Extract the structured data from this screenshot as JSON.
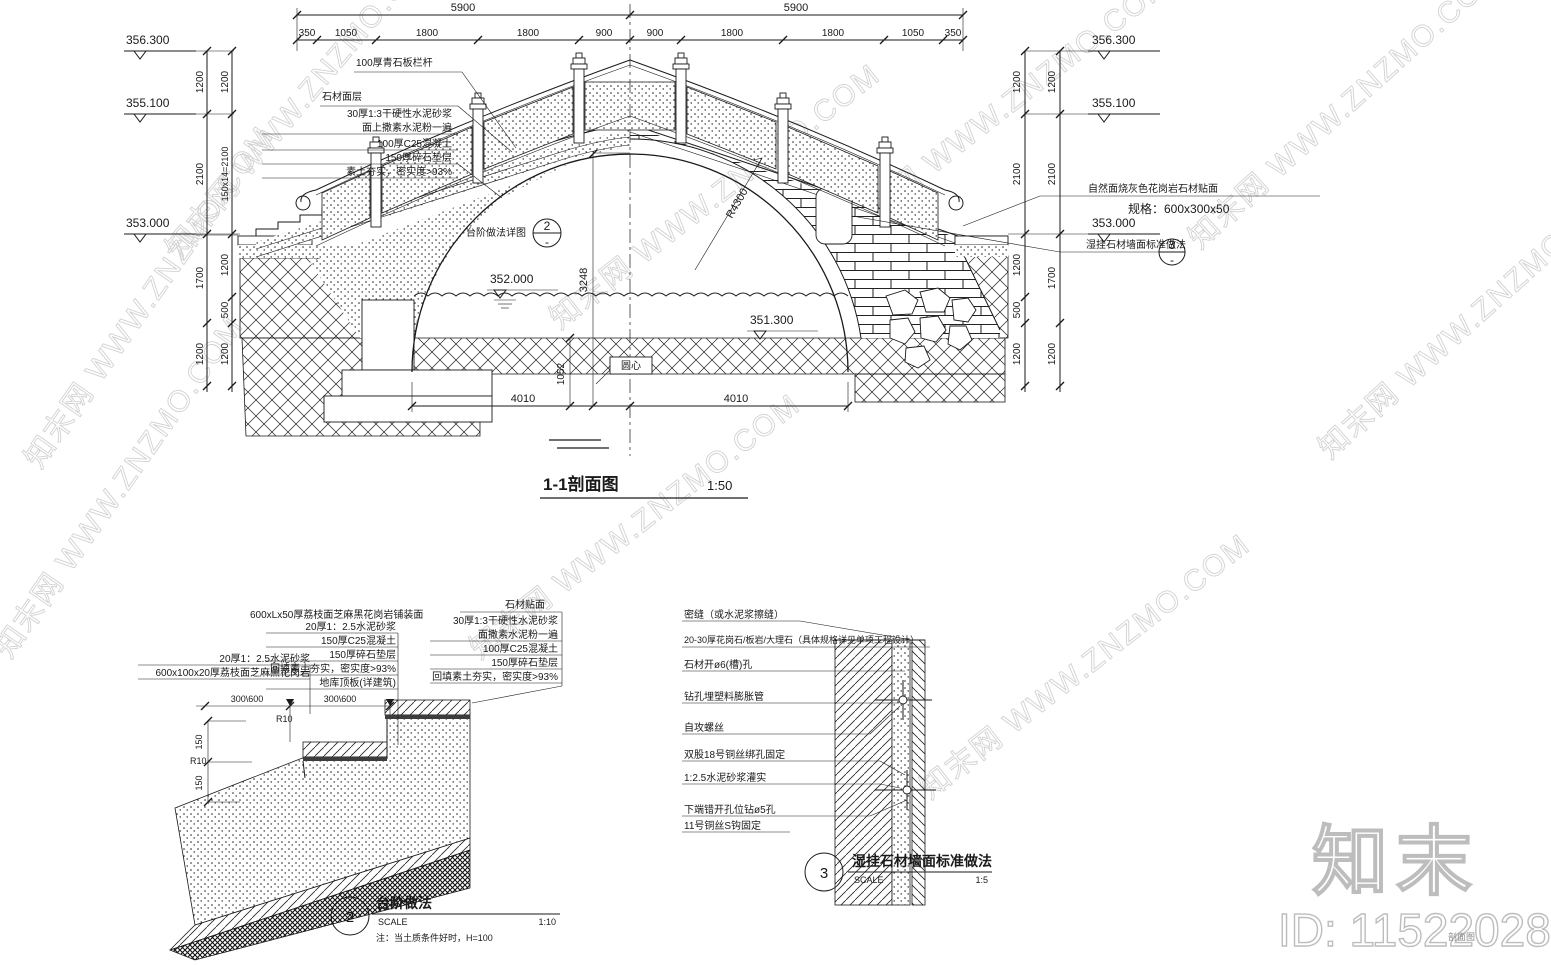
{
  "watermark": {
    "text": "知末网 WWW.ZNZMO.COM",
    "logo": "知末",
    "id": "ID: 1152202892",
    "corner": "剖面图"
  },
  "section": {
    "title": "1-1剖面图",
    "scale": "1:50",
    "top_totals": [
      "5900",
      "5900"
    ],
    "top_segs": [
      "350",
      "1050",
      "1800",
      "1800",
      "900",
      "900",
      "1800",
      "1800",
      "1050",
      "350"
    ],
    "levels_left": [
      "356.300",
      "355.100",
      "353.000"
    ],
    "levels_right": [
      "356.300",
      "355.100",
      "353.000"
    ],
    "level_water": "352.000",
    "level_bed": "351.300",
    "vl_outer": [
      "1200",
      "2100",
      "1700",
      "1200"
    ],
    "vl_inner": [
      "1200",
      "150x14=2100",
      "1200",
      "500",
      "1200"
    ],
    "vr_inner": [
      "1200",
      "2100",
      "1200",
      "500",
      "1200"
    ],
    "vr_outer": [
      "1200",
      "2100",
      "1700",
      "1200"
    ],
    "bottom_dims": [
      "4010",
      "4010"
    ],
    "radius": "R4300",
    "dim_rise": "3248",
    "dim_1052": "1052",
    "center": "圆心",
    "railing_note": "100厚青石板栏杆",
    "surface_note": "石材面层",
    "layers": [
      "30厚1:3干硬性水泥砂浆",
      "面上撒素水泥粉一遍",
      "100厚C25混凝土",
      "150厚碎石垫层",
      "素土夯实，密实度>93%"
    ],
    "step_callout": {
      "label": "台阶做法详图",
      "num": "2",
      "sheet": "-"
    },
    "stone_note1": "自然面烧灰色花岗岩石材贴面",
    "stone_note2": "规格：600x300x50",
    "wall_callout": {
      "label": "湿挂石材墙面标准做法",
      "num": "3",
      "sheet": "-"
    }
  },
  "detail2": {
    "num": "2",
    "title": "台阶做法",
    "scale_label": "SCALE",
    "scale": "1:10",
    "note": "注：当土质条件好时，H=100",
    "left_labels": [
      "20厚1：2.5水泥砂浆",
      "600x100x20厚荔枝面芝麻黑花岗岩"
    ],
    "top_label": "600xLx50厚荔枝面芝麻黑花岗岩铺装面",
    "mid_labels": [
      "20厚1：2.5水泥砂浆",
      "150厚C25混凝土",
      "150厚碎石垫层",
      "回填素土夯实，密实度>93%",
      "地库顶板(详建筑)"
    ],
    "right_title": "石材贴面",
    "right_labels": [
      "30厚1:3干硬性水泥砂浆",
      "面撒素水泥粉一遍",
      "100厚C25混凝土",
      "150厚碎石垫层",
      "回填素土夯实，密实度>93%"
    ],
    "dim_300_600": "300\\600",
    "dim_r10": "R10",
    "dim_150": "150"
  },
  "detail3": {
    "num": "3",
    "title": "湿挂石材墙面标准做法",
    "scale_label": "SCALE",
    "scale": "1:5",
    "labels": [
      "密缝（或水泥浆擦缝）",
      "20-30厚花岗石/板岩/大理石（具体规格详见单项工程设计）",
      "石材开ø6(槽)孔",
      "钻孔埋塑料膨胀管",
      "自攻螺丝",
      "双股18号铜丝绑孔固定",
      "1:2.5水泥砂浆灌实",
      "下端错开孔位钻ø5孔",
      "11号铜丝S钩固定"
    ]
  }
}
